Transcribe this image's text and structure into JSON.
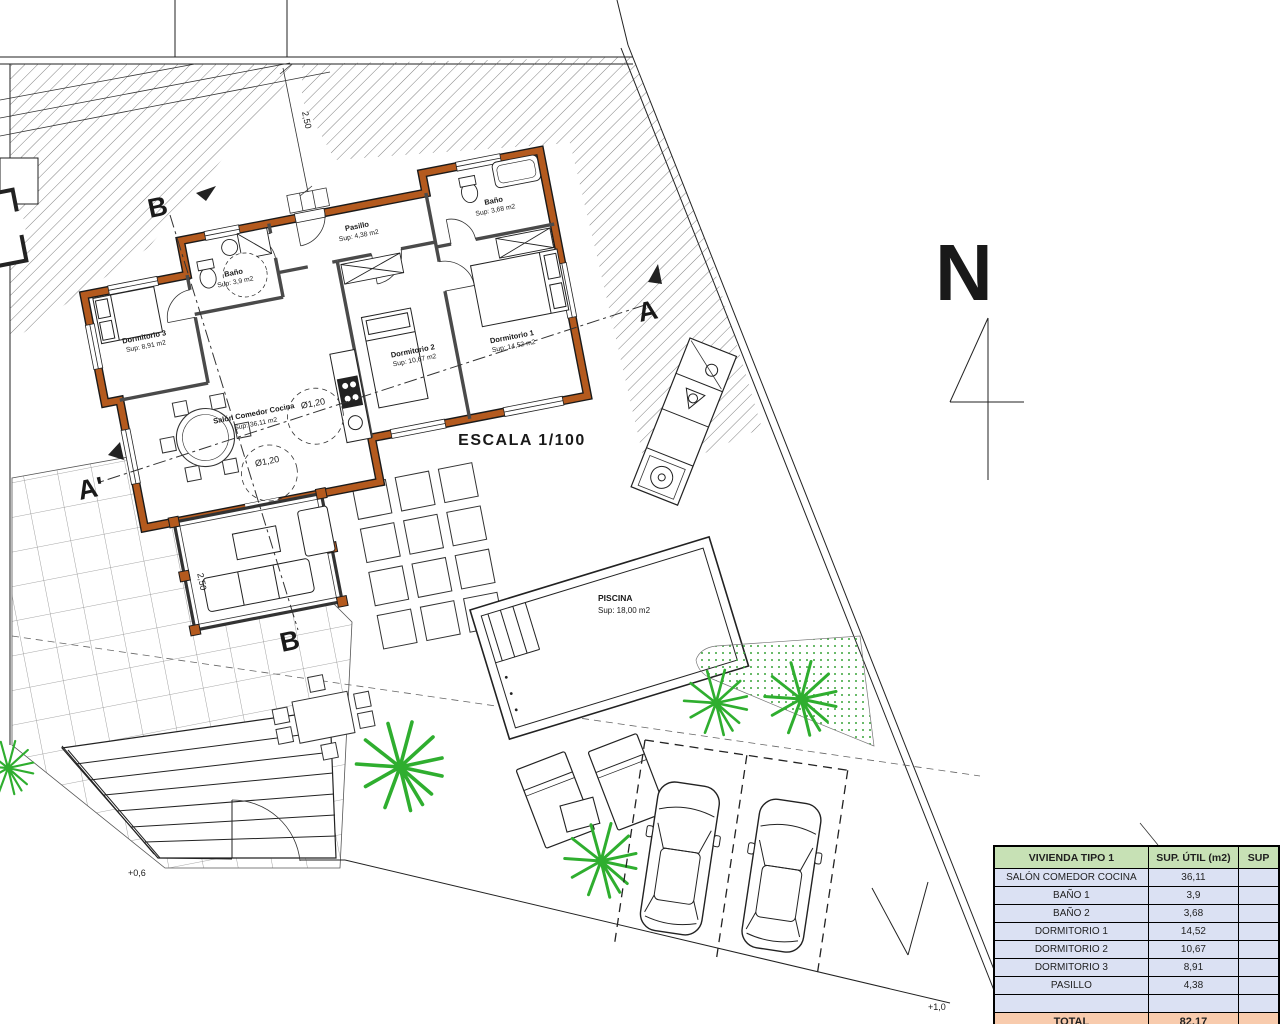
{
  "drawing": {
    "scale_label": "ESCALA 1/100",
    "compass_letter": "N",
    "sections": {
      "b_top": "B",
      "b_bottom": "B",
      "a": "A",
      "a_prime": "A'"
    },
    "levels": {
      "left": "+0,6",
      "right": "+1,0"
    },
    "dimensions": {
      "plot_top": "2,50",
      "porch": "2,50",
      "turn_circle_1": "Ø1,20",
      "turn_circle_2": "Ø1,20"
    },
    "rooms": {
      "trastero": {
        "name": "Trastero",
        "area": "4,00 m2"
      },
      "salon": {
        "name": "Salón Comedor Cocina",
        "area": "Sup: 36,11 m2"
      },
      "bano1": {
        "name": "Baño",
        "area": "Sup: 3,9 m2"
      },
      "bano2": {
        "name": "Baño",
        "area": "Sup: 3,68 m2"
      },
      "dorm1": {
        "name": "Dormitorio 1",
        "area": "Sup: 14,52 m2"
      },
      "dorm2": {
        "name": "Dormitorio 2",
        "area": "Sup: 10,67 m2"
      },
      "dorm3": {
        "name": "Dormitorio 3",
        "area": "Sup: 8,91 m2"
      },
      "pasillo": {
        "name": "Pasillo",
        "area": "Sup: 4,38 m2"
      },
      "piscina": {
        "name": "PISCINA",
        "area": "Sup: 18,00 m2"
      }
    }
  },
  "table": {
    "header": [
      "VIVIENDA TIPO 1",
      "SUP. ÚTIL (m2)",
      "SUP"
    ],
    "rows": [
      [
        "SALÓN COMEDOR COCINA",
        "36,11"
      ],
      [
        "BAÑO 1",
        "3,9"
      ],
      [
        "BAÑO 2",
        "3,68"
      ],
      [
        "DORMITORIO 1",
        "14,52"
      ],
      [
        "DORMITORIO 2",
        "10,67"
      ],
      [
        "DORMITORIO 3",
        "8,91"
      ],
      [
        "PASILLO",
        "4,38"
      ],
      [
        "",
        ""
      ]
    ],
    "total": [
      "TOTAL",
      "82,17"
    ]
  },
  "colors": {
    "wall_brick": "#b45a1e",
    "plant_green": "#2fae2f",
    "table_header_bg": "#c7e1b5",
    "table_row_bg": "#dbe1f3",
    "table_total_bg": "#f8cbad",
    "line": "#222222"
  }
}
